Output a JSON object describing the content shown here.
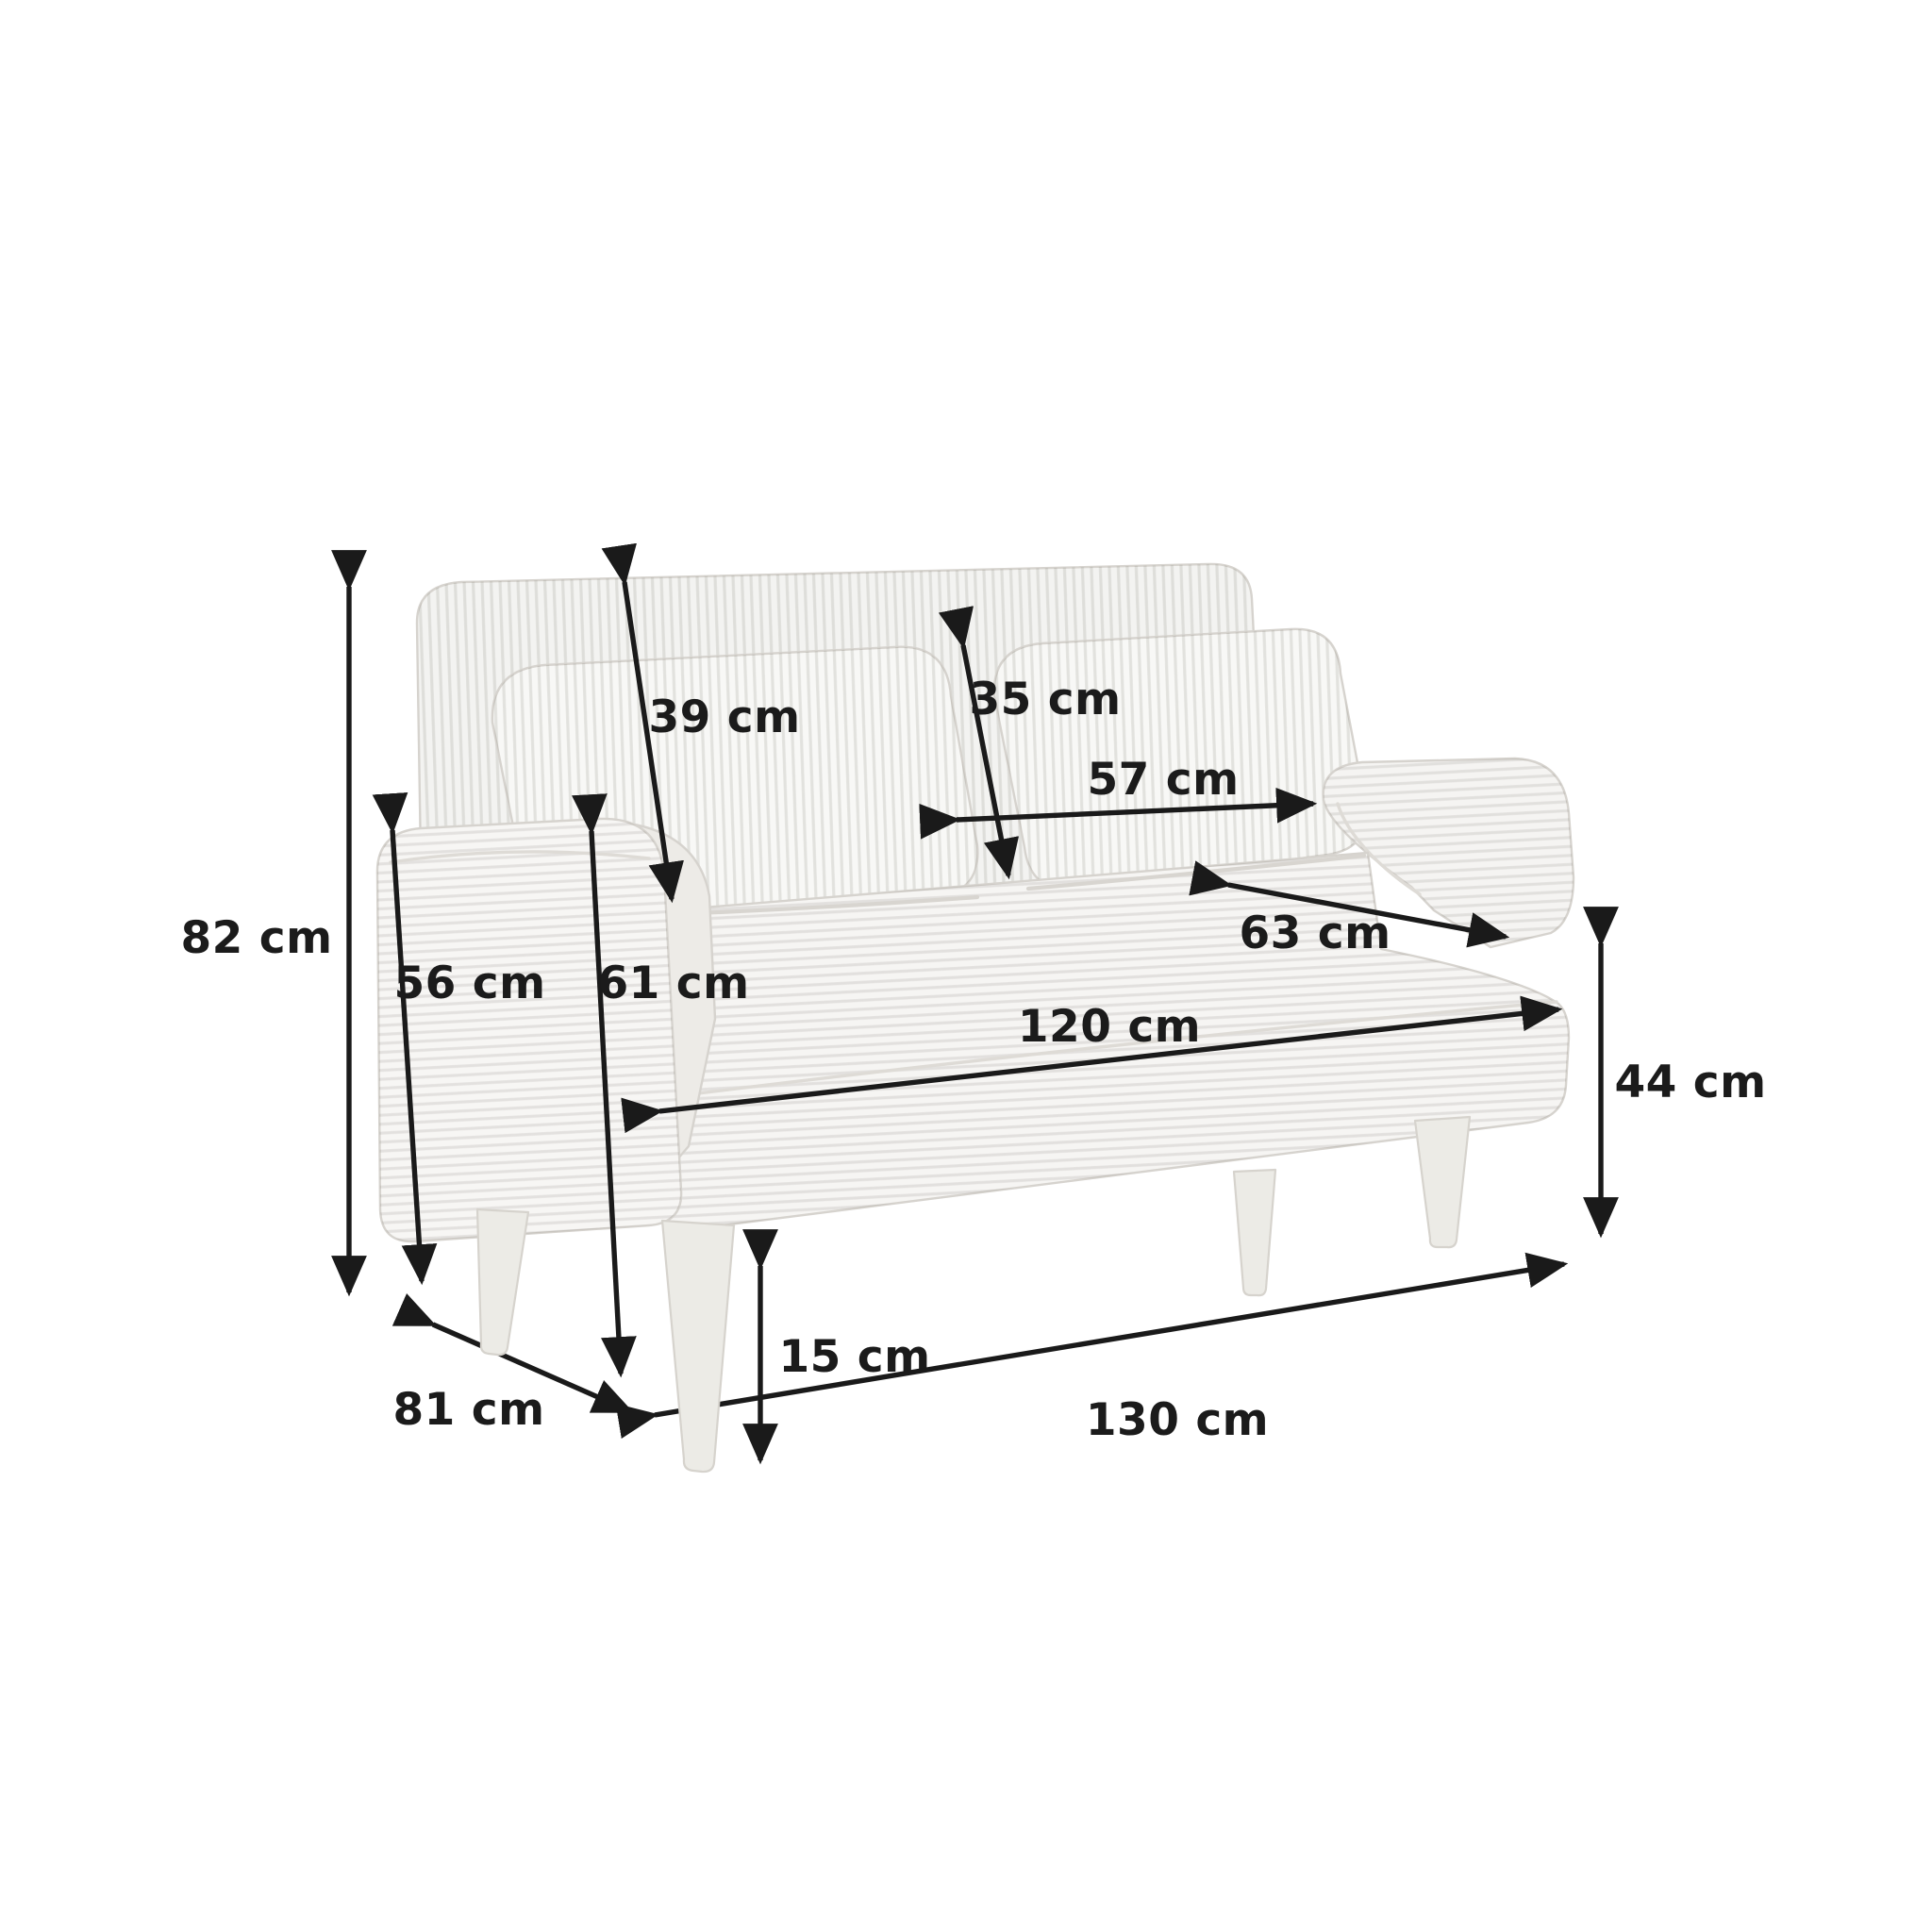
{
  "diagram": {
    "type": "product-dimension-diagram",
    "subject": "two-seater corduroy sofa, three-quarter perspective view",
    "unit": "cm",
    "colors": {
      "background": "#ffffff",
      "dimension_lines": "#1a1a1a",
      "label_text": "#1b1b1b",
      "fabric_base": "#f7f6f4",
      "fabric_backrest": "#f3f3f1",
      "fabric_shadow": "#edebe7",
      "fabric_outline": "#d6d3ce",
      "legs": "#ecebe6"
    },
    "labels": {
      "overall_height": "82 cm",
      "armrest_height": "56 cm",
      "seat_front_floor_height": "61 cm",
      "backrest_height": "39 cm",
      "back_cushion_height": "35 cm",
      "back_cushion_width": "57 cm",
      "seat_depth": "63 cm",
      "seat_width": "120 cm",
      "seat_height": "44 cm",
      "leg_height": "15 cm",
      "overall_depth": "81 cm",
      "overall_width": "130 cm"
    }
  }
}
